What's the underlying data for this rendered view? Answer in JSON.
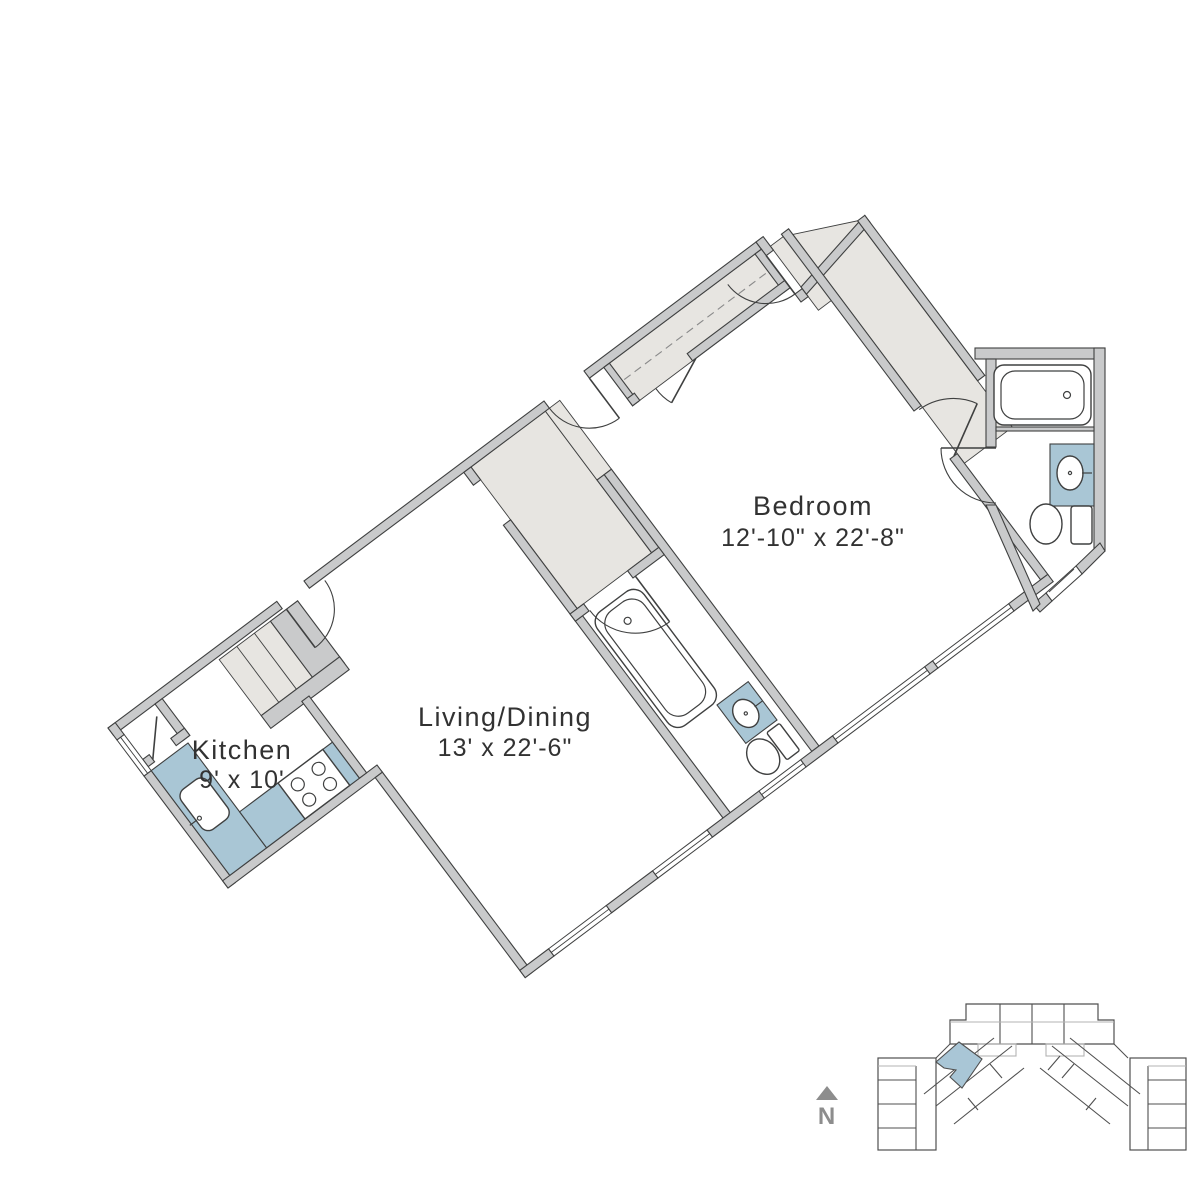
{
  "rooms": {
    "bedroom": {
      "name": "Bedroom",
      "dims": "12'-10\" x 22'-8\""
    },
    "living": {
      "name": "Living/Dining",
      "dims": "13' x 22'-6\""
    },
    "kitchen": {
      "name": "Kitchen",
      "dims": "9' x 10'"
    }
  },
  "compass": {
    "label": "N"
  },
  "colors": {
    "wall": "#c9cacb",
    "line": "#3f4040",
    "floorgray": "#e7e5e1",
    "blue": "#a9c6d5",
    "text": "#323232",
    "kline": "#4f4f4f",
    "kgray": "#b3b3b3",
    "kblue": "#a9c6d6",
    "compass": "#8d8d8d"
  }
}
